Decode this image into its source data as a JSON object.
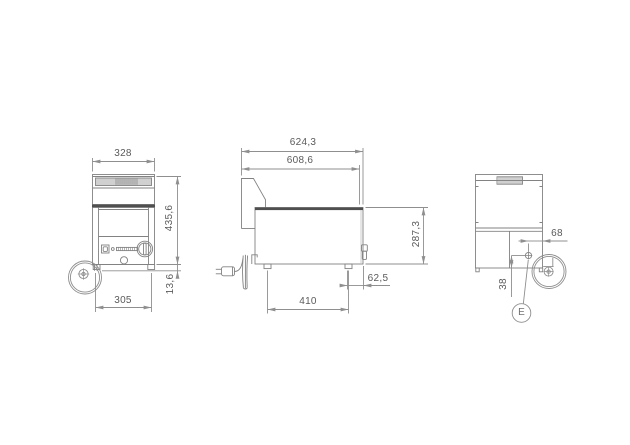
{
  "drawing": {
    "front_view": {
      "width_top": "328",
      "height": "435,6",
      "feet_height": "13,6",
      "width_bottom": "305"
    },
    "side_view": {
      "depth_total": "624,3",
      "depth_body": "608,6",
      "body_height": "287,3",
      "foot_offset": "62,5",
      "feet_spacing": "410"
    },
    "rear_view": {
      "connection_from_side": "68",
      "connection_from_bottom": "38",
      "detail_label": "E"
    },
    "colors": {
      "object_line": "#828282",
      "dimension_line": "#8f8f8f",
      "dark_band": "#4f4f4f",
      "text": "#5a5a5a",
      "background": "#ffffff"
    }
  }
}
